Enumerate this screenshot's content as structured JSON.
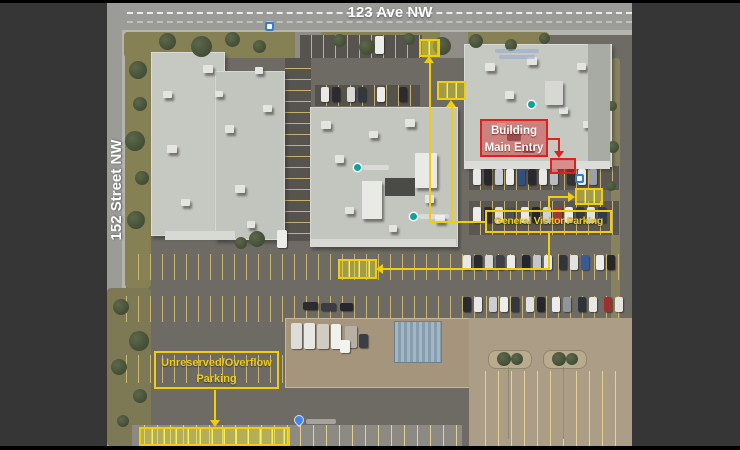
{
  "map": {
    "streets": {
      "top": "123 Ave NW",
      "left": "152 Street NW"
    },
    "labels": {
      "building_main_entry_line1": "Building",
      "building_main_entry_line2": "Main Entry",
      "general_visitor_parking": "General Visitor Parking",
      "unreserved_overflow_line1": "Unreserved/Overflow",
      "unreserved_overflow_line2": "Parking"
    },
    "colors": {
      "highlight_yellow": "#f2cd0e",
      "highlight_yellow_fill": "rgba(233,223,30,0.42)",
      "accent_red": "#e21f1f",
      "accent_red_fill": "rgba(210,30,30,0.42)",
      "street_label": "#ffffff"
    },
    "icons": {
      "bus_stop": "bus-stop-icon",
      "place_pin": "place-pin-icon",
      "parking_pin": "parking-pin-icon"
    }
  }
}
